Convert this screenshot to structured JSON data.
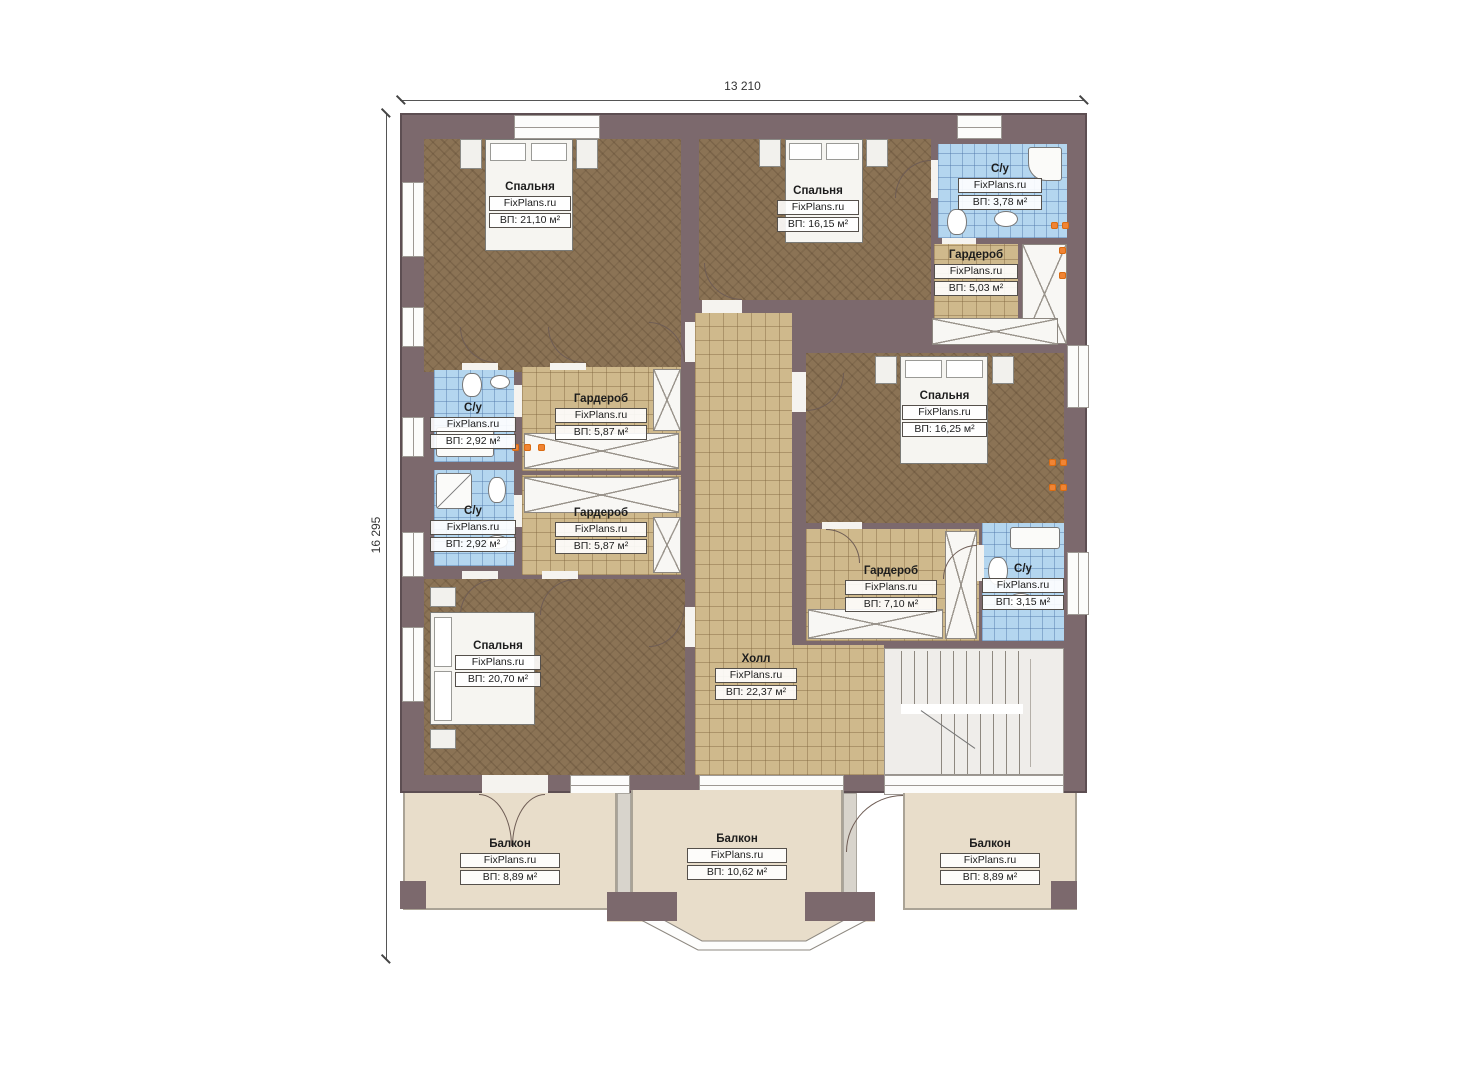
{
  "plan": {
    "watermark": "FixPlans.ru",
    "dimensions": {
      "width_label": "13 210",
      "height_label": "16 295"
    },
    "colors": {
      "wall": "#7c696d",
      "bedroom_floor": "#8b7355",
      "tile_floor": "#cfb98c",
      "bathroom_floor": "#b4d6ef",
      "balcony_floor": "#e8ddca",
      "marker_orange": "#f08434"
    }
  },
  "rooms": {
    "bedroomTL": {
      "name": "Спальня",
      "watermark": "FixPlans.ru",
      "area": "ВП: 21,10 м²"
    },
    "bedroomTM": {
      "name": "Спальня",
      "watermark": "FixPlans.ru",
      "area": "ВП: 16,15 м²"
    },
    "bathTR": {
      "name": "С/у",
      "watermark": "FixPlans.ru",
      "area": "ВП: 3,78 м²"
    },
    "wardrobeR": {
      "name": "Гардероб",
      "watermark": "FixPlans.ru",
      "area": "ВП: 5,03 м²"
    },
    "bedroomR": {
      "name": "Спальня",
      "watermark": "FixPlans.ru",
      "area": "ВП: 16,25 м²"
    },
    "bathL1": {
      "name": "С/у",
      "watermark": "FixPlans.ru",
      "area": "ВП: 2,92 м²"
    },
    "wardrobe1": {
      "name": "Гардероб",
      "watermark": "FixPlans.ru",
      "area": "ВП: 5,87 м²"
    },
    "bathL2": {
      "name": "С/у",
      "watermark": "FixPlans.ru",
      "area": "ВП: 2,92 м²"
    },
    "wardrobe2": {
      "name": "Гардероб",
      "watermark": "FixPlans.ru",
      "area": "ВП: 5,87 м²"
    },
    "bedroomBL": {
      "name": "Спальня",
      "watermark": "FixPlans.ru",
      "area": "ВП: 20,70 м²"
    },
    "hall": {
      "name": "Холл",
      "watermark": "FixPlans.ru",
      "area": "ВП: 22,37 м²"
    },
    "wardrobeB": {
      "name": "Гардероб",
      "watermark": "FixPlans.ru",
      "area": "ВП: 7,10 м²"
    },
    "bathBR": {
      "name": "С/у",
      "watermark": "FixPlans.ru",
      "area": "ВП: 3,15 м²"
    },
    "balconyL": {
      "name": "Балкон",
      "watermark": "FixPlans.ru",
      "area": "ВП: 8,89 м²"
    },
    "balconyC": {
      "name": "Балкон",
      "watermark": "FixPlans.ru",
      "area": "ВП: 10,62 м²"
    },
    "balconyR": {
      "name": "Балкон",
      "watermark": "FixPlans.ru",
      "area": "ВП: 8,89 м²"
    }
  }
}
